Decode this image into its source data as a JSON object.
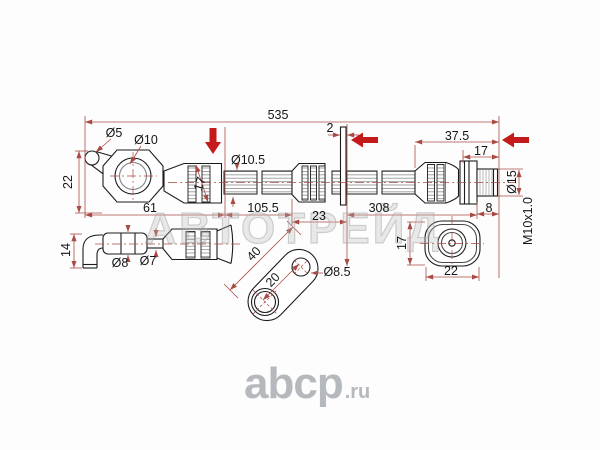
{
  "watermark": "АВТОТРЕЙД",
  "logo": {
    "brand": "abcp",
    "tld": ".ru"
  },
  "colors": {
    "dimension_line": "#a94a44",
    "part_line": "#1c1c1c",
    "accent_arrow": "#c41a1a",
    "watermark_gray": "#b9b9b9",
    "logo_gray": "#b5b8bd"
  },
  "dimensions": {
    "overall_length": "535",
    "tab_hole_dia": "Ø5",
    "eye_hole_dia": "Ø10",
    "banjo_height": "22",
    "banjo_across_flats": "17",
    "banjo_section_length": "61",
    "hose_dia": "Ø10.5",
    "section_a": "105.5",
    "bracket_plate_thickness": "2",
    "section_b": "23",
    "section_c": "308",
    "end_fitting_length": "37.5",
    "fitting_body_length": "17",
    "collar_dia": "Ø15",
    "thread_length": "8",
    "thread_spec": "M10x1.0",
    "elbow_drop": "14",
    "sleeve_dia": "Ø8",
    "tube_dia": "Ø7",
    "bracket_length": "40",
    "bracket_hole_spacing": "20",
    "bracket_hole_dia": "Ø8.5",
    "end_view_height": "17",
    "end_view_width": "22"
  }
}
